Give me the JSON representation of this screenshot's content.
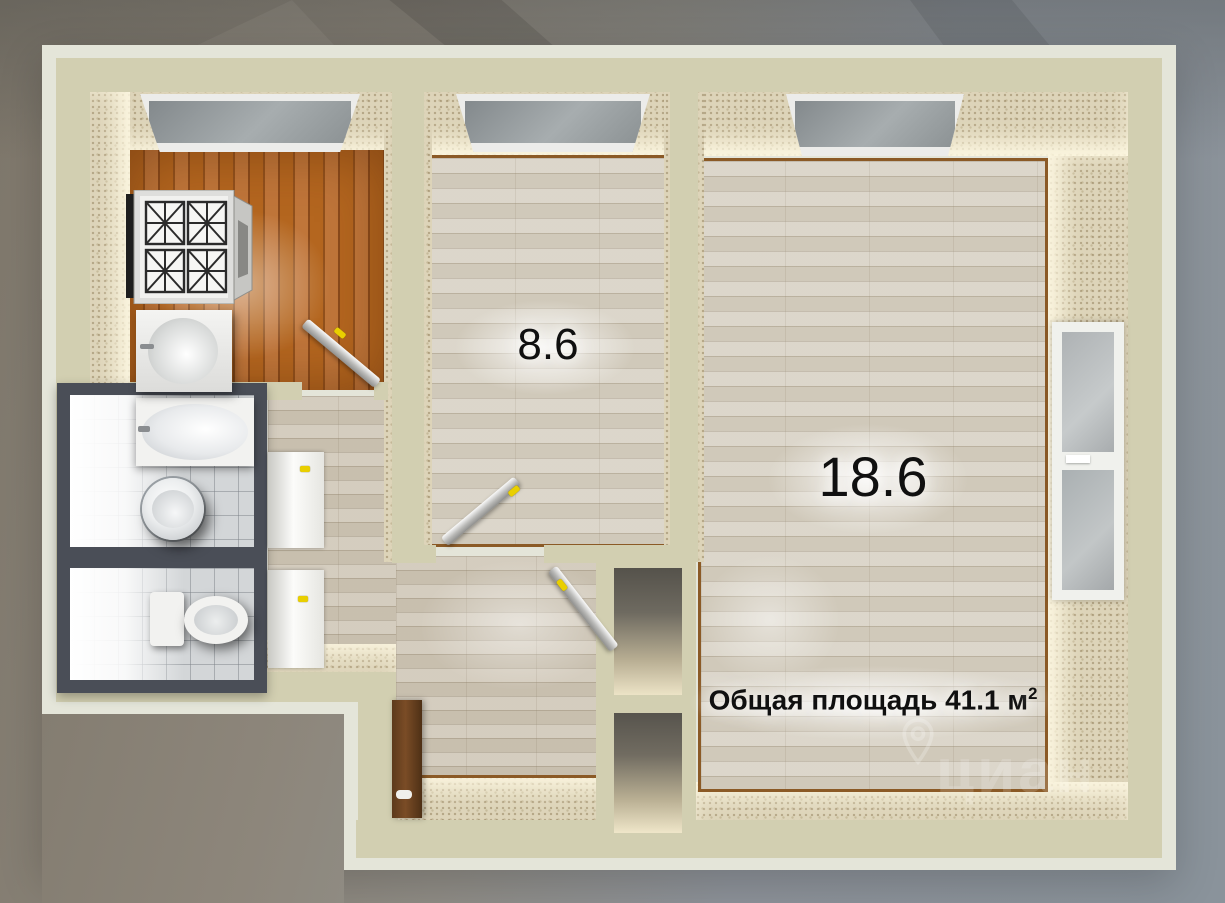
{
  "image": {
    "type": "3d-floor-plan-render",
    "language": "ru"
  },
  "labels": {
    "room_small_area": "8.6",
    "room_large_area": "18.6",
    "total_area": "Общая площадь 41.1 м",
    "total_area_sup": "2"
  },
  "watermark": {
    "text": "циан",
    "icon": "location-pin"
  },
  "rooms": [
    "kitchen",
    "room-8.6",
    "room-18.6",
    "bathroom",
    "toilet",
    "hallway",
    "entry-corridor"
  ],
  "fixtures": [
    "gas-stove",
    "kitchen-sink",
    "bathtub",
    "wash-basin",
    "toilet-bowl",
    "hallway-cabinet"
  ],
  "windows": [
    "kitchen-window",
    "small-room-window",
    "large-room-window",
    "side-window"
  ],
  "doors": [
    "kitchen-door",
    "small-room-door",
    "entry-door",
    "bathroom-door",
    "toilet-door"
  ],
  "colors": {
    "background_left": "#8a8378",
    "background_right": "#8a939b",
    "wall_edge": "#e4e5d9",
    "wall_top": "#d2cfb1",
    "wall_face": "#ddd4b9",
    "floor_light_wood": "#d8d2c5",
    "floor_kitchen_wood": "#a55a22",
    "floor_trim": "#8b5a26",
    "bathroom_frame": "#4a4e57",
    "door_handle": "#e9cf00",
    "label_text": "#101010"
  }
}
